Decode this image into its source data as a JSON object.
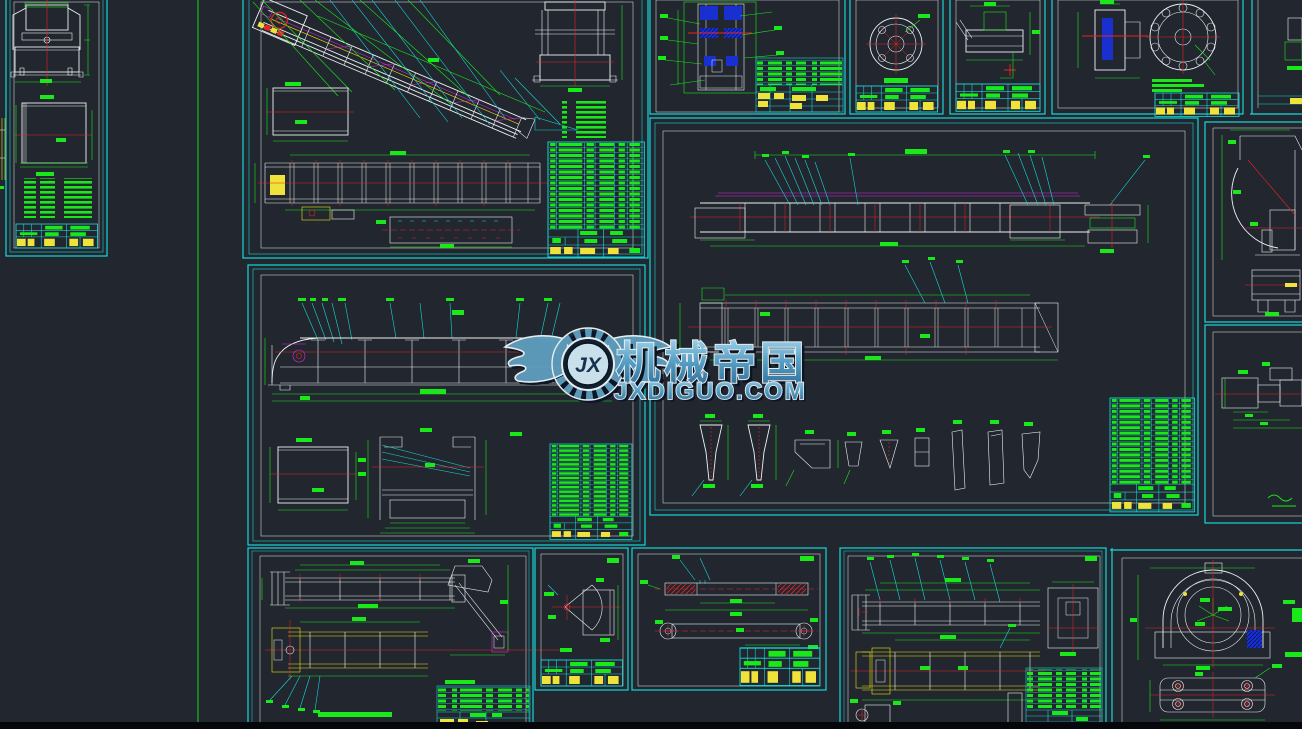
{
  "watermark": {
    "monogram": "JX",
    "brand": "机械帝国",
    "domain": "JXDIGUO.COM",
    "wing_color": "#5d9cbd",
    "text_color_top": "#9ed7f0",
    "text_color_bottom": "#2b6f9d"
  },
  "palette": {
    "background": "#21262f",
    "sheet_border_cyan": "#17d8d8",
    "drawing_line_white": "#eef2f2",
    "centerline_red": "#e82424",
    "dimension_green": "#1ae81a",
    "leader_cyan": "#17d8d8",
    "highlight_yellow": "#eee316",
    "detail_magenta": "#de2ade",
    "section_fill_blue": "#1830cf",
    "table_cell_yellow": "#efe23a"
  },
  "canvas": {
    "type": "CAD drawing preview",
    "sheet_count_visible": 16
  }
}
